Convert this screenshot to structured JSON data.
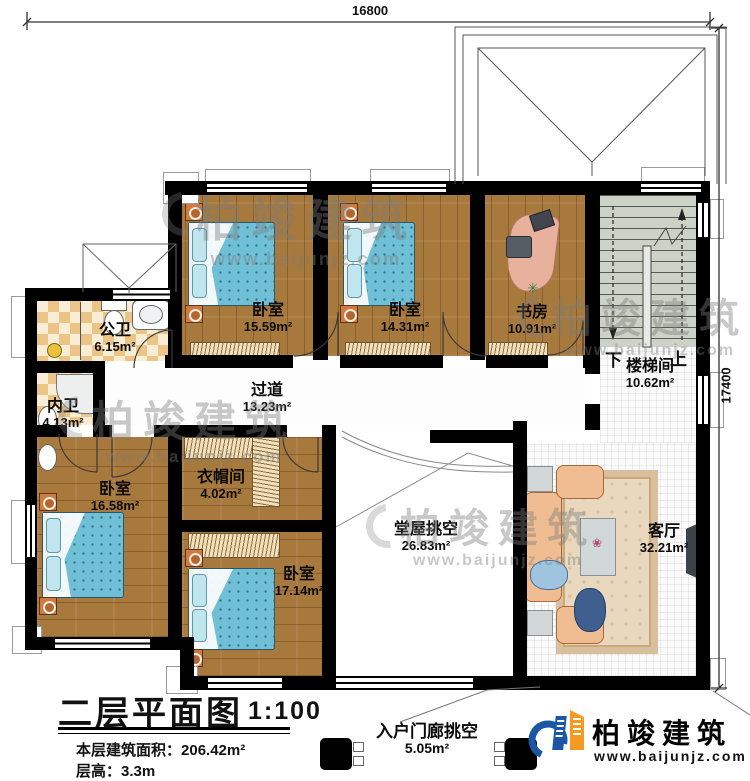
{
  "dimensions": {
    "top": "16800",
    "right": "17400"
  },
  "rooms": [
    {
      "name": "卧室",
      "area": "15.59m²"
    },
    {
      "name": "卧室",
      "area": "14.31m²"
    },
    {
      "name": "书房",
      "area": "10.91m²"
    },
    {
      "name": "楼梯间",
      "area": "10.62m²"
    },
    {
      "name": "公卫",
      "area": "6.15m²"
    },
    {
      "name": "内卫",
      "area": "4.13m²"
    },
    {
      "name": "过道",
      "area": "13.23m²"
    },
    {
      "name": "衣帽间",
      "area": "4.02m²"
    },
    {
      "name": "卧室",
      "area": "16.58m²"
    },
    {
      "name": "卧室",
      "area": "17.14m²"
    },
    {
      "name": "堂屋挑空",
      "area": "26.83m²"
    },
    {
      "name": "客厅",
      "area": "32.21m²"
    }
  ],
  "stairs": {
    "down_label": "下",
    "up_label": "上"
  },
  "porch": {
    "name": "入户门廊挑空",
    "area": "5.05m²"
  },
  "title_block": {
    "title": "二层平面图",
    "scale": "1:100",
    "floor_area_label": "本层建筑面积：",
    "floor_area_value": "206.42m²",
    "floor_height_label": "层高：",
    "floor_height_value": "3.3m"
  },
  "brand": {
    "name": "柏竣建筑",
    "website": "www.baijunjz.com"
  },
  "watermark": {
    "name": "柏竣建筑",
    "website": "www.baijunjz.com"
  },
  "colors": {
    "wall": "#000000",
    "wood_floor": "#a8793c",
    "tile_accent": "#ecc486",
    "bed": "#6fc0d6",
    "stair": "#ccd3c6",
    "logo_blue": "#1b57a5",
    "logo_orange": "#f59a20"
  }
}
